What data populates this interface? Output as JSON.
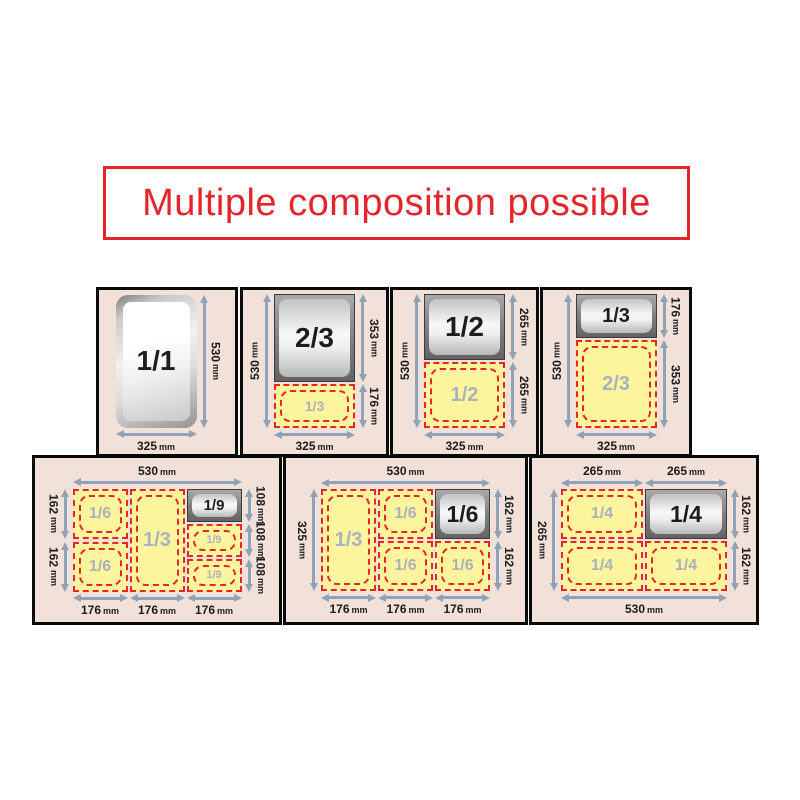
{
  "title": {
    "text": "Multiple composition possible"
  },
  "unit": "mm",
  "colors": {
    "title_red": "#e5252c",
    "red_dashed": "#e8262a",
    "yellow": "#fdf49e",
    "panel_bg": "#f1e1d9",
    "arrow": "#8fa2b6",
    "label_gray": "#a8b1bd"
  },
  "panels": [
    {
      "name": "1-1",
      "row": "top",
      "box": {
        "x": 96,
        "y": 287,
        "w": 142,
        "h": 170
      },
      "grid": {
        "columns": [
          {
            "width": 325,
            "cells": [
              {
                "kind": "pan",
                "open": true,
                "label": "1/1",
                "height": 530
              }
            ]
          }
        ]
      },
      "dims": {
        "top": [],
        "left": [],
        "right": [
          {
            "value": "530",
            "mm": 530,
            "full": true
          }
        ],
        "bottom": [
          {
            "value": "325",
            "mm": 325,
            "full": true
          }
        ]
      }
    },
    {
      "name": "2-3-plus-1-3",
      "row": "top",
      "box": {
        "x": 240,
        "y": 287,
        "w": 149,
        "h": 170
      },
      "grid": {
        "columns": [
          {
            "width": 325,
            "cells": [
              {
                "kind": "pan",
                "label": "2/3",
                "height": 353
              },
              {
                "kind": "dashed",
                "label": "1/3",
                "height": 176
              }
            ]
          }
        ]
      },
      "dims": {
        "top": [],
        "left": [
          {
            "value": "530",
            "mm": 530,
            "full": true
          }
        ],
        "right": [
          {
            "value": "353",
            "mm": 353
          },
          {
            "value": "176",
            "mm": 176
          }
        ],
        "bottom": [
          {
            "value": "325",
            "mm": 325,
            "full": true
          }
        ]
      }
    },
    {
      "name": "1-2-plus-1-2",
      "row": "top",
      "box": {
        "x": 390,
        "y": 287,
        "w": 149,
        "h": 170
      },
      "grid": {
        "columns": [
          {
            "width": 325,
            "cells": [
              {
                "kind": "pan",
                "label": "1/2",
                "height": 265
              },
              {
                "kind": "dashed",
                "label": "1/2",
                "height": 265
              }
            ]
          }
        ]
      },
      "dims": {
        "top": [],
        "left": [
          {
            "value": "530",
            "mm": 530,
            "full": true
          }
        ],
        "right": [
          {
            "value": "265",
            "mm": 265
          },
          {
            "value": "265",
            "mm": 265
          }
        ],
        "bottom": [
          {
            "value": "325",
            "mm": 325,
            "full": true
          }
        ]
      }
    },
    {
      "name": "1-3-plus-2-3",
      "row": "top",
      "box": {
        "x": 540,
        "y": 287,
        "w": 152,
        "h": 170
      },
      "grid": {
        "columns": [
          {
            "width": 325,
            "cells": [
              {
                "kind": "pan",
                "label": "1/3",
                "height": 176
              },
              {
                "kind": "dashed",
                "label": "2/3",
                "height": 353
              }
            ]
          }
        ]
      },
      "dims": {
        "top": [],
        "left": [
          {
            "value": "530",
            "mm": 530,
            "full": true
          }
        ],
        "right": [
          {
            "value": "176",
            "mm": 176
          },
          {
            "value": "353",
            "mm": 353
          }
        ],
        "bottom": [
          {
            "value": "325",
            "mm": 325,
            "full": true
          }
        ]
      }
    },
    {
      "name": "1-6-1-3-1-9",
      "row": "bottom",
      "box": {
        "x": 32,
        "y": 455,
        "w": 250,
        "h": 170
      },
      "grid": {
        "columns": [
          {
            "width": 176,
            "cells": [
              {
                "kind": "dashed",
                "label": "1/6",
                "height": 162
              },
              {
                "kind": "dashed",
                "label": "1/6",
                "height": 162
              }
            ]
          },
          {
            "width": 176,
            "cells": [
              {
                "kind": "dashed",
                "label": "1/3",
                "height": 325
              }
            ]
          },
          {
            "width": 176,
            "cells": [
              {
                "kind": "pan",
                "label": "1/9",
                "height": 108
              },
              {
                "kind": "dashed",
                "label": "1/9",
                "height": 108
              },
              {
                "kind": "dashed",
                "label": "1/9",
                "height": 108
              }
            ]
          }
        ]
      },
      "dims": {
        "top": [
          {
            "value": "530",
            "mm": 530,
            "full": true
          }
        ],
        "left": [
          {
            "value": "162",
            "mm": 162
          },
          {
            "value": "162",
            "mm": 162
          }
        ],
        "right": [
          {
            "value": "108",
            "mm": 108
          },
          {
            "value": "108",
            "mm": 108
          },
          {
            "value": "108",
            "mm": 108
          }
        ],
        "bottom": [
          {
            "value": "176",
            "mm": 176
          },
          {
            "value": "176",
            "mm": 176
          },
          {
            "value": "176",
            "mm": 176
          }
        ]
      }
    },
    {
      "name": "1-3-1-6-1-6",
      "row": "bottom",
      "box": {
        "x": 283,
        "y": 455,
        "w": 245,
        "h": 170
      },
      "grid": {
        "columns": [
          {
            "width": 176,
            "cells": [
              {
                "kind": "dashed",
                "label": "1/3",
                "height": 325
              }
            ]
          },
          {
            "width": 176,
            "cells": [
              {
                "kind": "dashed",
                "label": "1/6",
                "height": 162
              },
              {
                "kind": "dashed",
                "label": "1/6",
                "height": 162
              }
            ]
          },
          {
            "width": 176,
            "cells": [
              {
                "kind": "pan",
                "label": "1/6",
                "height": 162
              },
              {
                "kind": "dashed",
                "label": "1/6",
                "height": 162
              }
            ]
          }
        ]
      },
      "dims": {
        "top": [
          {
            "value": "530",
            "mm": 530,
            "full": true
          }
        ],
        "left": [
          {
            "value": "325",
            "mm": 325,
            "full": true
          }
        ],
        "right": [
          {
            "value": "162",
            "mm": 162
          },
          {
            "value": "162",
            "mm": 162
          }
        ],
        "bottom": [
          {
            "value": "176",
            "mm": 176
          },
          {
            "value": "176",
            "mm": 176
          },
          {
            "value": "176",
            "mm": 176
          }
        ]
      }
    },
    {
      "name": "quarters-1-4",
      "row": "bottom",
      "box": {
        "x": 529,
        "y": 455,
        "w": 230,
        "h": 170
      },
      "grid": {
        "columns": [
          {
            "width": 265,
            "cells": [
              {
                "kind": "dashed",
                "label": "1/4",
                "height": 162
              },
              {
                "kind": "dashed",
                "label": "1/4",
                "height": 162
              }
            ]
          },
          {
            "width": 265,
            "cells": [
              {
                "kind": "pan",
                "label": "1/4",
                "height": 162
              },
              {
                "kind": "dashed",
                "label": "1/4",
                "height": 162
              }
            ]
          }
        ]
      },
      "dims": {
        "top": [
          {
            "value": "265",
            "mm": 265
          },
          {
            "value": "265",
            "mm": 265
          }
        ],
        "left": [
          {
            "value": "265",
            "mm": 265,
            "full": true
          }
        ],
        "right": [
          {
            "value": "162",
            "mm": 162
          },
          {
            "value": "162",
            "mm": 162
          }
        ],
        "bottom": [
          {
            "value": "530",
            "mm": 530,
            "full": true
          }
        ]
      }
    }
  ]
}
